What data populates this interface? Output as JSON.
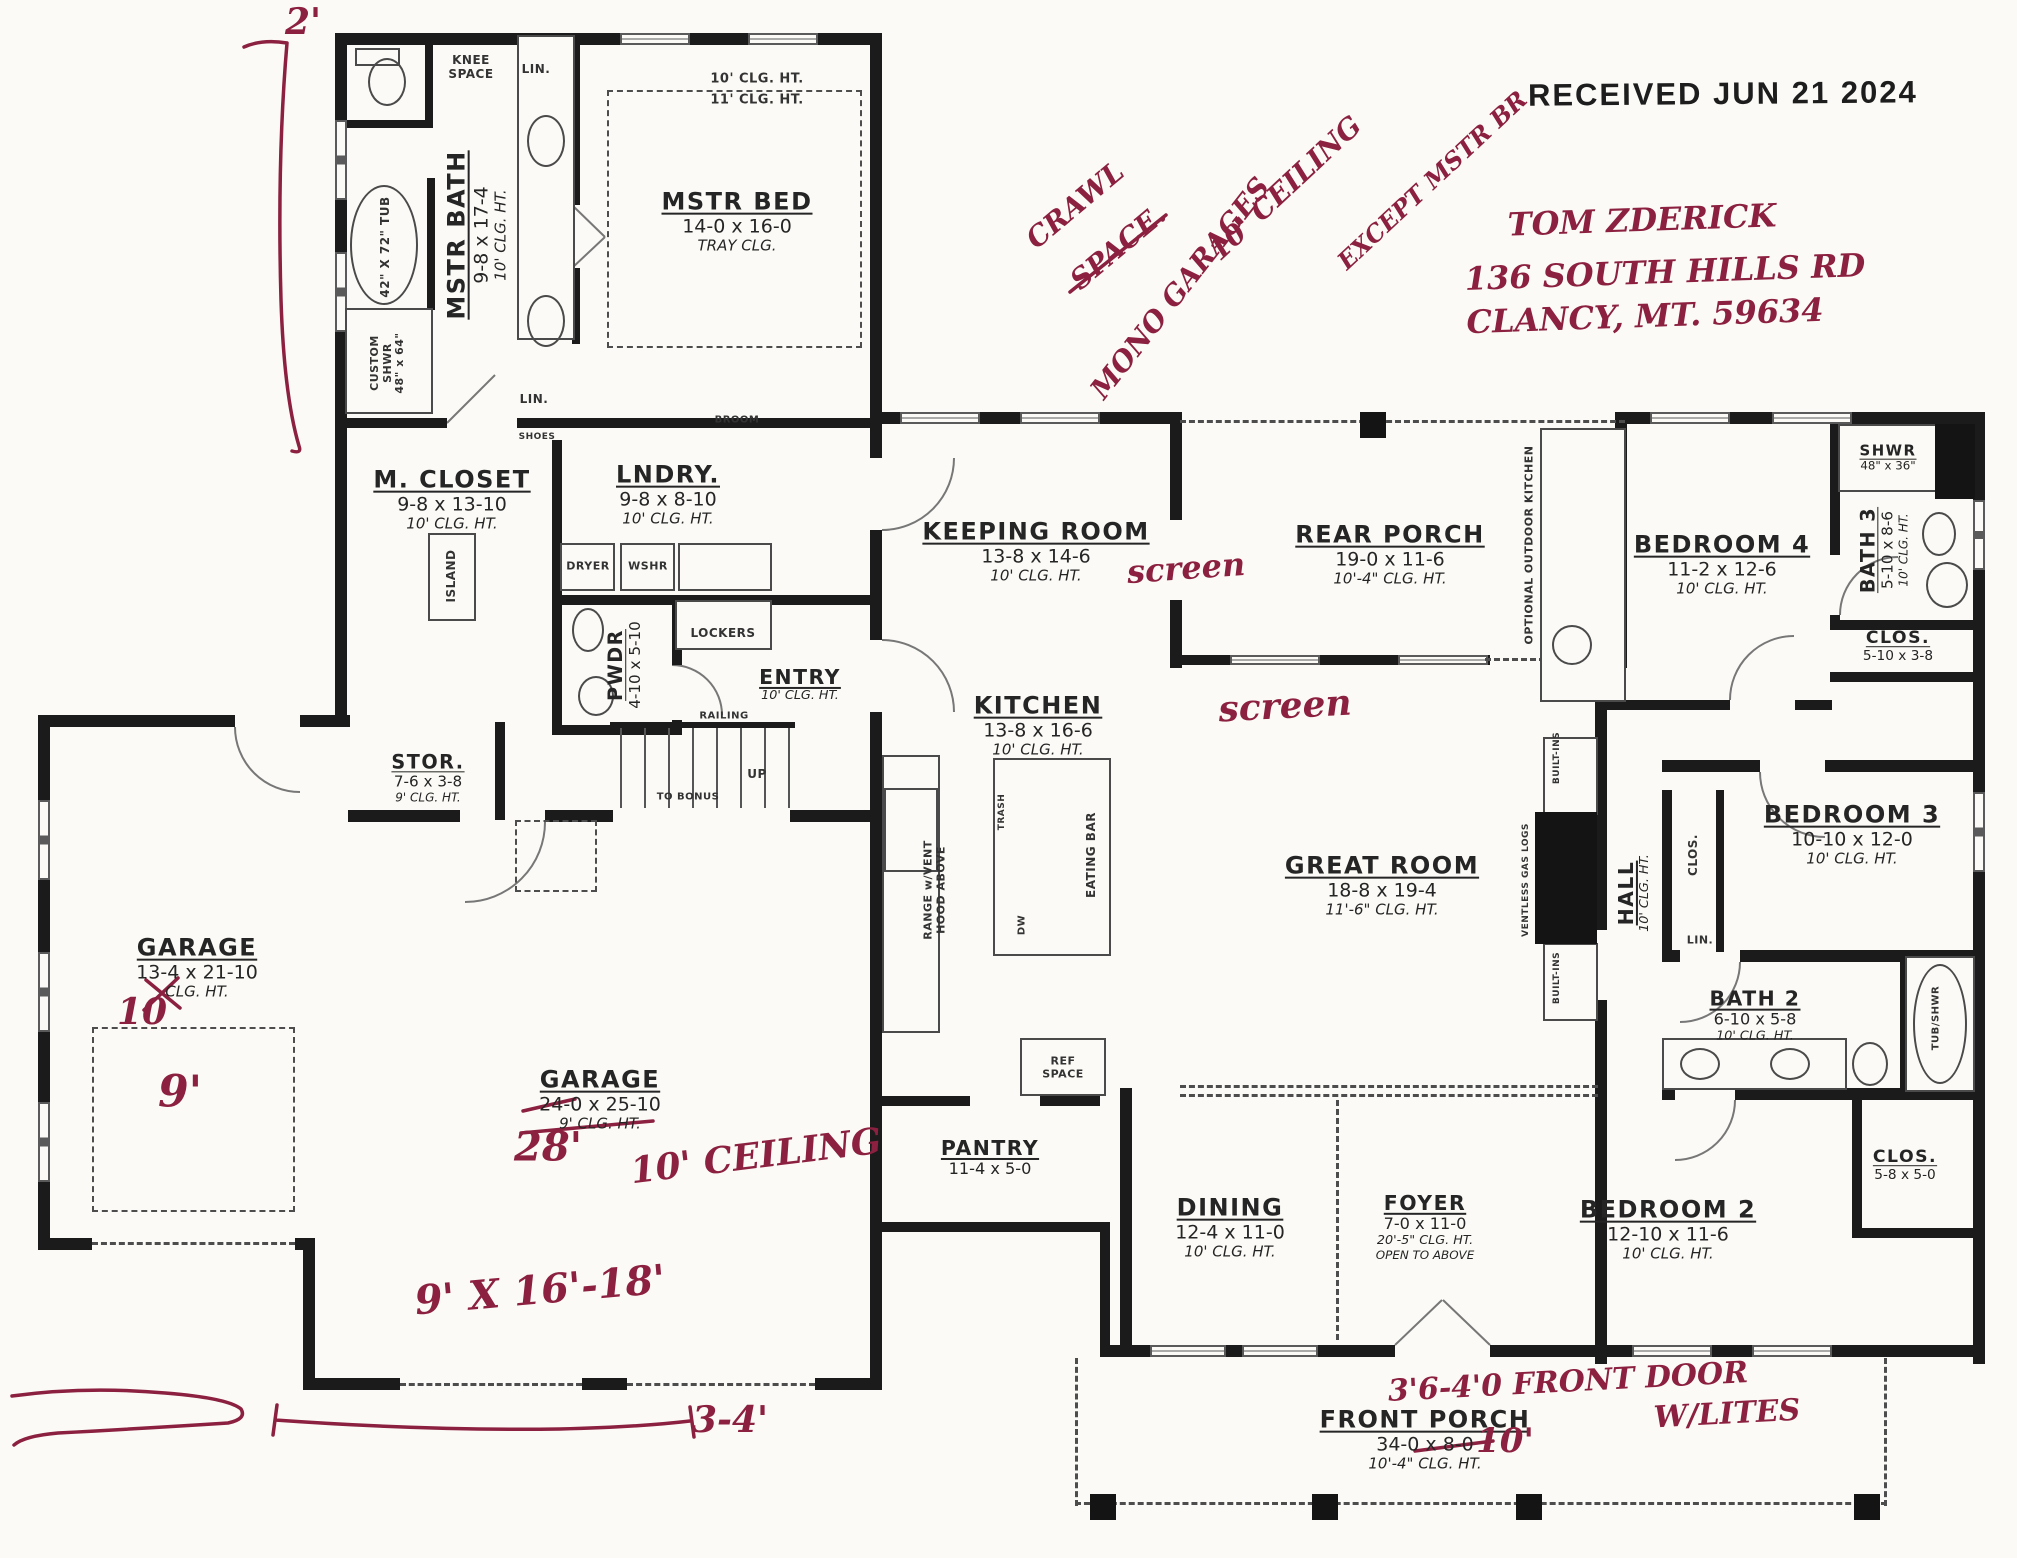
{
  "stamp": {
    "text": "RECEIVED JUN 21 2024"
  },
  "ink_color": "#8b2040",
  "rooms": [
    {
      "id": "mstr-bed",
      "name": "MSTR BED",
      "dims": "14-0 x 16-0",
      "clg": "TRAY CLG.",
      "x": 737,
      "y": 222
    },
    {
      "id": "mstr-bath",
      "name": "MSTR BATH",
      "dims": "9-8 x 17-4",
      "clg": "10' CLG. HT.",
      "x": 477,
      "y": 235,
      "vert": true
    },
    {
      "id": "m-closet",
      "name": "M. CLOSET",
      "dims": "9-8 x 13-10",
      "clg": "10' CLG. HT.",
      "x": 452,
      "y": 500
    },
    {
      "id": "lndry",
      "name": "LNDRY.",
      "dims": "9-8 x 8-10",
      "clg": "10' CLG. HT.",
      "x": 668,
      "y": 495
    },
    {
      "id": "pwdr",
      "name": "PWDR",
      "dims": "4-10 x 5-10",
      "x": 625,
      "y": 665,
      "vert": true,
      "sc": 0.8
    },
    {
      "id": "entry",
      "name": "ENTRY",
      "clg": "10' CLG. HT.",
      "x": 800,
      "y": 685,
      "sc": 0.85
    },
    {
      "id": "stor",
      "name": "STOR.",
      "dims": "7-6 x 3-8",
      "clg": "9' CLG. HT.",
      "x": 428,
      "y": 778,
      "sc": 0.8
    },
    {
      "id": "garage-left",
      "name": "GARAGE",
      "dims": "13-4 x 21-10",
      "clg": "CLG. HT.",
      "x": 197,
      "y": 968
    },
    {
      "id": "garage-main",
      "name": "GARAGE",
      "dims": "24-0 x 25-10",
      "clg": "9' CLG. HT.",
      "x": 600,
      "y": 1100
    },
    {
      "id": "keeping-room",
      "name": "KEEPING ROOM",
      "dims": "13-8 x 14-6",
      "clg": "10' CLG. HT.",
      "x": 1036,
      "y": 552
    },
    {
      "id": "kitchen",
      "name": "KITCHEN",
      "dims": "13-8 x 16-6",
      "clg": "10' CLG. HT.",
      "x": 1038,
      "y": 726
    },
    {
      "id": "rear-porch",
      "name": "REAR PORCH",
      "dims": "19-0 x 11-6",
      "clg": "10'-4\" CLG. HT.",
      "x": 1390,
      "y": 555
    },
    {
      "id": "bedroom-4",
      "name": "BEDROOM 4",
      "dims": "11-2 x 12-6",
      "clg": "10' CLG. HT.",
      "x": 1722,
      "y": 565
    },
    {
      "id": "bath-3",
      "name": "BATH 3",
      "dims": "5-10 x 8-6",
      "clg": "10' CLG. HT.",
      "x": 1884,
      "y": 550,
      "vert": true,
      "sc": 0.8
    },
    {
      "id": "shwr-bath3",
      "name": "SHWR",
      "dims": "48\" x 36\"",
      "x": 1888,
      "y": 458,
      "sc": 0.62
    },
    {
      "id": "clos-bath3",
      "name": "CLOS.",
      "dims": "5-10 x 3-8",
      "x": 1898,
      "y": 647,
      "sc": 0.72
    },
    {
      "id": "great-room",
      "name": "GREAT ROOM",
      "dims": "18-8 x 19-4",
      "clg": "11'-6\" CLG. HT.",
      "x": 1382,
      "y": 886
    },
    {
      "id": "hall",
      "name": "HALL",
      "clg": "10' CLG. HT.",
      "x": 1634,
      "y": 893,
      "vert": true,
      "sc": 0.85
    },
    {
      "id": "bedroom-3",
      "name": "BEDROOM 3",
      "dims": "10-10 x 12-0",
      "clg": "10' CLG. HT.",
      "x": 1852,
      "y": 835
    },
    {
      "id": "bath-2",
      "name": "BATH 2",
      "dims": "6-10 x 5-8",
      "clg": "10' CLG. HT.",
      "x": 1755,
      "y": 1016,
      "sc": 0.85
    },
    {
      "id": "pantry",
      "name": "PANTRY",
      "dims": "11-4 x 5-0",
      "x": 990,
      "y": 1158,
      "sc": 0.85
    },
    {
      "id": "dining",
      "name": "DINING",
      "dims": "12-4 x 11-0",
      "clg": "10' CLG. HT.",
      "x": 1230,
      "y": 1228
    },
    {
      "id": "foyer",
      "name": "FOYER",
      "dims": "7-0 x 11-0",
      "clg": "20'-5\" CLG. HT.",
      "extra": "OPEN TO ABOVE",
      "x": 1425,
      "y": 1227,
      "sc": 0.85
    },
    {
      "id": "bedroom-2",
      "name": "BEDROOM 2",
      "dims": "12-10 x 11-6",
      "clg": "10' CLG. HT.",
      "x": 1668,
      "y": 1230
    },
    {
      "id": "clos-bed2",
      "name": "CLOS.",
      "dims": "5-8 x 5-0",
      "x": 1905,
      "y": 1166,
      "sc": 0.72
    },
    {
      "id": "front-porch",
      "name": "FRONT PORCH",
      "dims": "34-0 x 8-0",
      "clg": "10'-4\" CLG. HT.",
      "x": 1425,
      "y": 1440
    }
  ],
  "labels": [
    {
      "id": "knee-space",
      "text": "KNEE\nSPACE",
      "x": 471,
      "y": 68,
      "sz": 12
    },
    {
      "id": "lin-top",
      "text": "LIN.",
      "x": 536,
      "y": 70,
      "sz": 12
    },
    {
      "id": "tray-clg-10",
      "text": "10' CLG. HT.",
      "x": 757,
      "y": 80,
      "sz": 13
    },
    {
      "id": "tray-clg-11",
      "text": "11' CLG. HT.",
      "x": 757,
      "y": 101,
      "sz": 13
    },
    {
      "id": "tub-42x72",
      "text": "42\" X 72\" TUB",
      "x": 386,
      "y": 247,
      "vert": true,
      "sz": 12
    },
    {
      "id": "custom-shwr",
      "text": "CUSTOM\nSHWR\n48\" x 64\"",
      "x": 388,
      "y": 363,
      "vert": true,
      "sz": 11
    },
    {
      "id": "lin-mid",
      "text": "LIN.",
      "x": 534,
      "y": 400,
      "sz": 12
    },
    {
      "id": "shoes",
      "text": "SHOES",
      "x": 537,
      "y": 437,
      "sz": 9
    },
    {
      "id": "island",
      "text": "ISLAND",
      "x": 452,
      "y": 576,
      "vert": true,
      "sz": 12
    },
    {
      "id": "dryer",
      "text": "DRYER",
      "x": 588,
      "y": 567,
      "sz": 11
    },
    {
      "id": "wshr",
      "text": "WSHR",
      "x": 648,
      "y": 567,
      "sz": 11
    },
    {
      "id": "broom",
      "text": "BROOM",
      "x": 737,
      "y": 420,
      "sz": 10
    },
    {
      "id": "lockers",
      "text": "LOCKERS",
      "x": 723,
      "y": 634,
      "sz": 12
    },
    {
      "id": "railing",
      "text": "RAILING",
      "x": 724,
      "y": 716,
      "sz": 10
    },
    {
      "id": "up",
      "text": "UP",
      "x": 757,
      "y": 775,
      "sz": 12
    },
    {
      "id": "to-bonus",
      "text": "TO BONUS",
      "x": 688,
      "y": 797,
      "sz": 10
    },
    {
      "id": "trash",
      "text": "TRASH",
      "x": 1002,
      "y": 812,
      "vert": true,
      "sz": 9
    },
    {
      "id": "eating-bar",
      "text": "EATING BAR",
      "x": 1092,
      "y": 855,
      "vert": true,
      "sz": 12
    },
    {
      "id": "dw",
      "text": "DW",
      "x": 1022,
      "y": 925,
      "vert": true,
      "sz": 10
    },
    {
      "id": "range-vent",
      "text": "RANGE w/VENT\nHOOD ABOVE",
      "x": 935,
      "y": 890,
      "vert": true,
      "sz": 11
    },
    {
      "id": "ref-space",
      "text": "REF\nSPACE",
      "x": 1063,
      "y": 1068,
      "sz": 11
    },
    {
      "id": "optional-outdoor-kitchen",
      "text": "OPTIONAL OUTDOOR KITCHEN",
      "x": 1530,
      "y": 545,
      "vert": true,
      "sz": 11
    },
    {
      "id": "ventless-gas-logs",
      "text": "VENTLESS GAS LOGS",
      "x": 1526,
      "y": 880,
      "vert": true,
      "sz": 9
    },
    {
      "id": "built-ins-top",
      "text": "BUILT-INS",
      "x": 1557,
      "y": 758,
      "vert": true,
      "sz": 9
    },
    {
      "id": "built-ins-bottom",
      "text": "BUILT-INS",
      "x": 1557,
      "y": 978,
      "vert": true,
      "sz": 9
    },
    {
      "id": "clos-bed3",
      "text": "CLOS.",
      "x": 1694,
      "y": 855,
      "vert": true,
      "sz": 12
    },
    {
      "id": "lin-hall",
      "text": "LIN.",
      "x": 1700,
      "y": 941,
      "sz": 11
    },
    {
      "id": "tub-shwr",
      "text": "TUB/SHWR",
      "x": 1936,
      "y": 1018,
      "vert": true,
      "sz": 10
    }
  ],
  "notes": [
    {
      "id": "two-ft",
      "text": "2'",
      "x": 303,
      "y": 22,
      "rot": 0,
      "sz": 36
    },
    {
      "id": "crawl",
      "text": "CRAWL",
      "x": 1075,
      "y": 205,
      "rot": -40,
      "sz": 28
    },
    {
      "id": "space",
      "text": "SPACE.",
      "x": 1118,
      "y": 247,
      "rot": -40,
      "sz": 28
    },
    {
      "id": "mono-garages",
      "text": "MONO GARAGES",
      "x": 1180,
      "y": 288,
      "rot": -52,
      "sz": 28
    },
    {
      "id": "ten-ceiling-diag",
      "text": "10' CEILING",
      "x": 1285,
      "y": 188,
      "rot": -43,
      "sz": 28
    },
    {
      "id": "except-mstr",
      "text": "EXCEPT MSTR BR",
      "x": 1432,
      "y": 180,
      "rot": -43,
      "sz": 24
    },
    {
      "id": "owner-name",
      "text": "TOM ZDERICK",
      "x": 1642,
      "y": 220,
      "rot": -2,
      "sz": 32
    },
    {
      "id": "owner-street",
      "text": "136 SOUTH HILLS RD",
      "x": 1665,
      "y": 272,
      "rot": -2,
      "sz": 32
    },
    {
      "id": "owner-city",
      "text": "CLANCY, MT. 59634",
      "x": 1645,
      "y": 316,
      "rot": -2,
      "sz": 32
    },
    {
      "id": "screen-1",
      "text": "screen",
      "x": 1186,
      "y": 568,
      "rot": -4,
      "sz": 32
    },
    {
      "id": "screen-2",
      "text": "screen",
      "x": 1285,
      "y": 706,
      "rot": -3,
      "sz": 36
    },
    {
      "id": "garage-28",
      "text": "28'",
      "x": 548,
      "y": 1147,
      "rot": 0,
      "sz": 40
    },
    {
      "id": "garage-10-ceiling",
      "text": "10' CEILING",
      "x": 756,
      "y": 1156,
      "rot": -7,
      "sz": 36
    },
    {
      "id": "garage-door-size",
      "text": "9' X 16'-18'",
      "x": 540,
      "y": 1290,
      "rot": -5,
      "sz": 40
    },
    {
      "id": "garage-left-10",
      "text": "10",
      "x": 142,
      "y": 1012,
      "rot": 0,
      "sz": 36
    },
    {
      "id": "garage-left-9",
      "text": "9'",
      "x": 180,
      "y": 1092,
      "rot": 0,
      "sz": 44
    },
    {
      "id": "three-four",
      "text": "3-4'",
      "x": 730,
      "y": 1420,
      "rot": 0,
      "sz": 36
    },
    {
      "id": "porch-10",
      "text": "10'",
      "x": 1505,
      "y": 1441,
      "rot": 0,
      "sz": 34
    },
    {
      "id": "front-door-note",
      "text": "3'6-4'0 FRONT DOOR",
      "x": 1568,
      "y": 1382,
      "rot": -3,
      "sz": 30
    },
    {
      "id": "w-lites",
      "text": "W/LITES",
      "x": 1727,
      "y": 1414,
      "rot": -3,
      "sz": 30
    }
  ]
}
